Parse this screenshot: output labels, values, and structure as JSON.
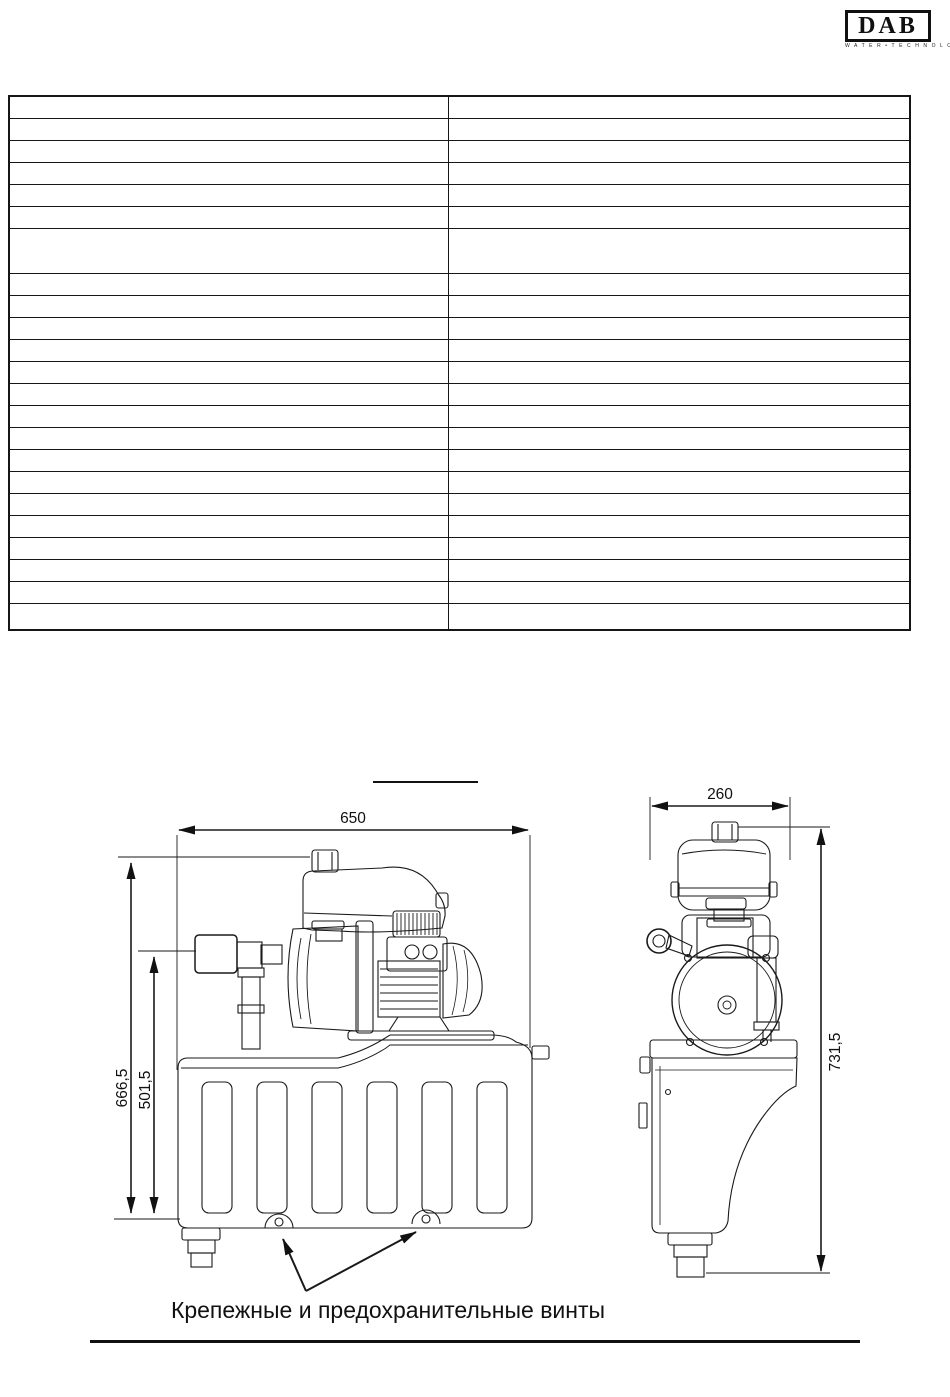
{
  "header": {
    "logo_text": "DAB",
    "logo_subtext": "W A T E R • T E C H N O L O G Y"
  },
  "table": {
    "columns": 2,
    "rows": [
      [
        "",
        ""
      ],
      [
        "",
        ""
      ],
      [
        "",
        ""
      ],
      [
        "",
        ""
      ],
      [
        "",
        ""
      ],
      [
        "",
        ""
      ],
      [
        "",
        ""
      ],
      [
        "",
        ""
      ],
      [
        "",
        ""
      ],
      [
        "",
        ""
      ],
      [
        "",
        ""
      ],
      [
        "",
        ""
      ],
      [
        "",
        ""
      ],
      [
        "",
        ""
      ],
      [
        "",
        ""
      ],
      [
        "",
        ""
      ],
      [
        "",
        ""
      ],
      [
        "",
        ""
      ],
      [
        "",
        ""
      ],
      [
        "",
        ""
      ],
      [
        "",
        ""
      ],
      [
        "",
        ""
      ],
      [
        "",
        ""
      ]
    ]
  },
  "figure": {
    "front_view": {
      "width_label": "650",
      "total_height_label": "666,5",
      "inlet_height_label": "501,5"
    },
    "side_view": {
      "width_label": "260",
      "height_label": "731,5"
    },
    "caption": "Крепежные и предохранительные винты"
  },
  "colors": {
    "line": "#1a1a1a",
    "background": "#ffffff"
  }
}
